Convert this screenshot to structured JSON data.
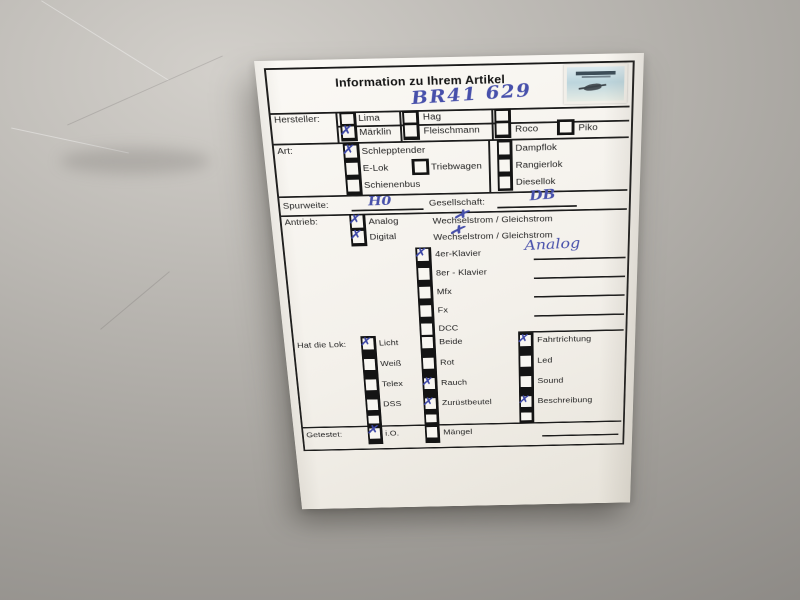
{
  "colors": {
    "ink_blue": "#4750ab",
    "paper": "#f5f2ec",
    "surface_gray": "#a9a6a1"
  },
  "logo_icon": "photo-shop-logo",
  "form": {
    "title": "Information zu Ihrem Artikel",
    "article_number": "BR41 629",
    "hersteller": {
      "label": "Hersteller:",
      "row1": [
        {
          "label": "Lima",
          "mark": ""
        },
        {
          "label": "Hag",
          "mark": ""
        }
      ],
      "row2": [
        {
          "label": "Märklin",
          "mark": "✗"
        },
        {
          "label": "Fleischmann",
          "mark": ""
        },
        {
          "label": "Roco",
          "mark": ""
        },
        {
          "label": "Piko",
          "mark": ""
        }
      ]
    },
    "art": {
      "label": "Art:",
      "col1": [
        {
          "label": "Schlepptender",
          "mark": "✗"
        },
        {
          "label": "E-Lok",
          "mark": ""
        },
        {
          "label": "Schienenbus",
          "mark": ""
        }
      ],
      "mid": [
        {
          "label": "Triebwagen",
          "mark": ""
        }
      ],
      "col2": [
        {
          "label": "Dampflok",
          "mark": ""
        },
        {
          "label": "Rangierlok",
          "mark": ""
        },
        {
          "label": "Diesellok",
          "mark": ""
        }
      ]
    },
    "spurweite": {
      "label": "Spurweite:",
      "value": "H0"
    },
    "gesellschaft": {
      "label": "Gesellschaft:",
      "value": "DB"
    },
    "antrieb": {
      "label": "Antrieb:",
      "rows": [
        {
          "label": "Analog",
          "mark": "✗",
          "text": "Wechselstrom / Gleichstrom",
          "text_mark": "✗"
        },
        {
          "label": "Digital",
          "mark": "✗",
          "text": "Wechselstrom / Gleichstrom",
          "text_mark": "✗"
        }
      ]
    },
    "decoder": {
      "items": [
        {
          "label": "4er-Klavier",
          "mark": "✗"
        },
        {
          "label": "8er - Klavier",
          "mark": ""
        },
        {
          "label": "Mfx",
          "mark": ""
        },
        {
          "label": "Fx",
          "mark": ""
        },
        {
          "label": "DCC",
          "mark": ""
        }
      ],
      "note": "Analog"
    },
    "lok": {
      "label": "Hat die Lok:",
      "col1": [
        {
          "label": "Licht",
          "mark": "✗"
        },
        {
          "label": "Weiß",
          "mark": ""
        },
        {
          "label": "Telex",
          "mark": ""
        },
        {
          "label": "DSS",
          "mark": ""
        }
      ],
      "col2": [
        {
          "label": "Beide",
          "mark": ""
        },
        {
          "label": "Rot",
          "mark": ""
        },
        {
          "label": "Rauch",
          "mark": "✗"
        },
        {
          "label": "Zurüstbeutel",
          "mark": "✗"
        }
      ],
      "col3": [
        {
          "label": "Fahrtrichtung",
          "mark": "✗"
        },
        {
          "label": "Led",
          "mark": ""
        },
        {
          "label": "Sound",
          "mark": ""
        },
        {
          "label": "Beschreibung",
          "mark": "✗"
        }
      ]
    },
    "getestet": {
      "label": "Getestet:",
      "options": [
        {
          "label": "i.O.",
          "mark": "✗"
        },
        {
          "label": "Mängel",
          "mark": ""
        }
      ]
    }
  }
}
